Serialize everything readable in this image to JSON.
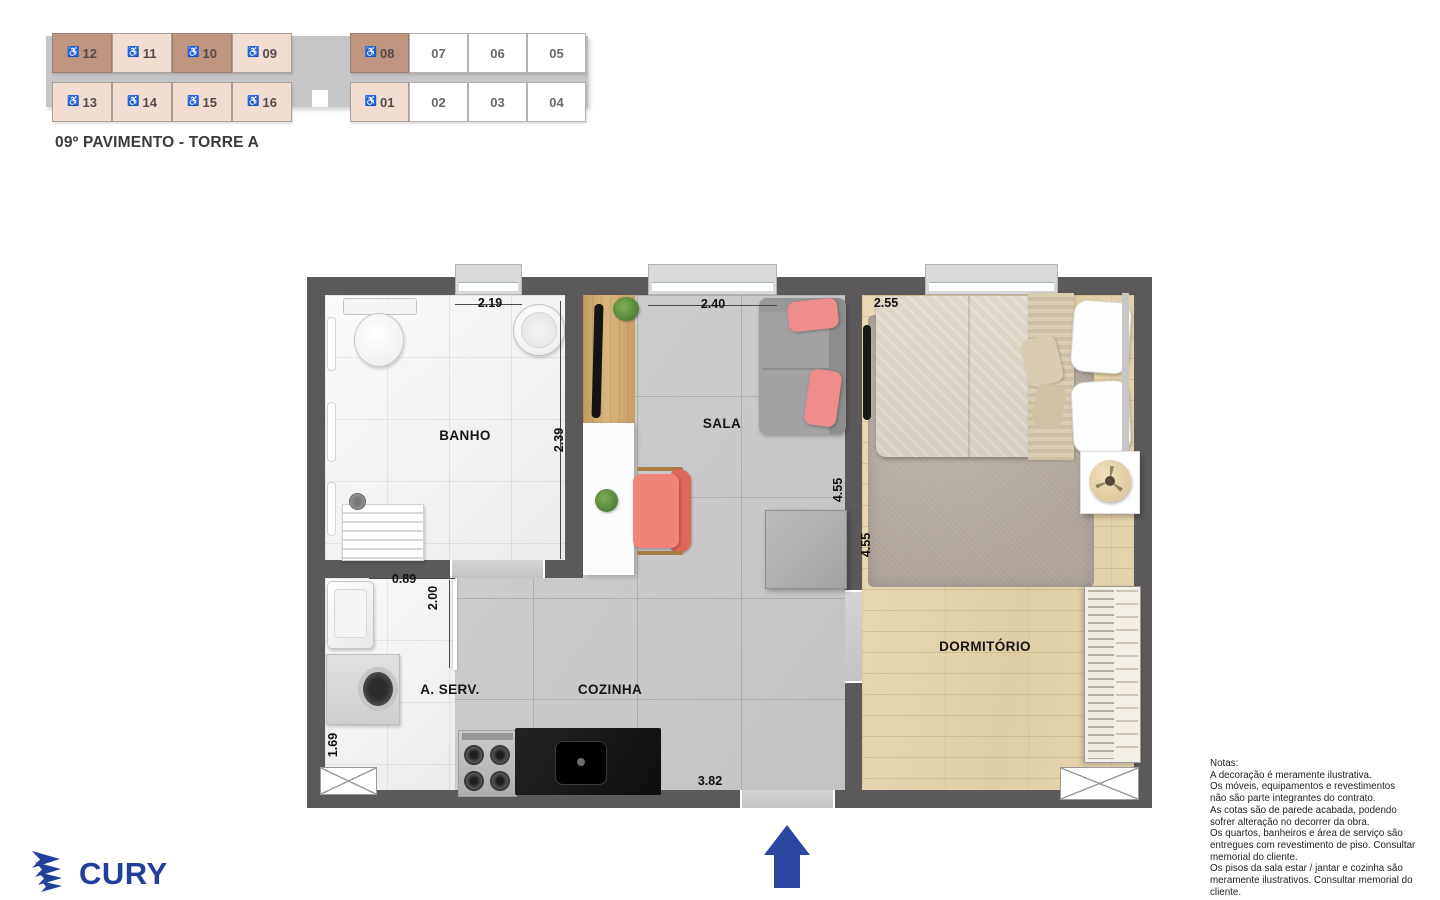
{
  "key_plan": {
    "floor_title": "09º PAVIMENTO - TORRE A",
    "wheelchair_char": "♿",
    "cells": [
      {
        "label": "12",
        "accessible": true,
        "tone": "dark"
      },
      {
        "label": "11",
        "accessible": true,
        "tone": "light"
      },
      {
        "label": "10",
        "accessible": true,
        "tone": "dark"
      },
      {
        "label": "09",
        "accessible": true,
        "tone": "light"
      },
      {
        "label": "08",
        "accessible": true,
        "tone": "dark"
      },
      {
        "label": "07",
        "accessible": false,
        "tone": "white"
      },
      {
        "label": "06",
        "accessible": false,
        "tone": "white"
      },
      {
        "label": "05",
        "accessible": false,
        "tone": "white"
      },
      {
        "label": "13",
        "accessible": true,
        "tone": "light"
      },
      {
        "label": "14",
        "accessible": true,
        "tone": "light"
      },
      {
        "label": "15",
        "accessible": true,
        "tone": "light"
      },
      {
        "label": "16",
        "accessible": true,
        "tone": "light"
      },
      {
        "label": "01",
        "accessible": true,
        "tone": "light"
      },
      {
        "label": "02",
        "accessible": false,
        "tone": "white"
      },
      {
        "label": "03",
        "accessible": false,
        "tone": "white"
      },
      {
        "label": "04",
        "accessible": false,
        "tone": "white"
      }
    ]
  },
  "floor_plan": {
    "rooms": {
      "banho": "BANHO",
      "sala": "SALA",
      "dormitorio": "DORMITÓRIO",
      "aserv": "A. SERV.",
      "cozinha": "COZINHA"
    },
    "dimensions": {
      "banho_w": "2.19",
      "sala_w": "2.40",
      "dorm_w": "2.55",
      "banho_h": "2.39",
      "sala_h": "4.55",
      "dorm_h": "4.55",
      "aserv_w": "0.89",
      "aserv_h": "2.00",
      "aserv_h2": "1.69",
      "cozinha_w": "3.82"
    }
  },
  "notes": {
    "title": "Notas:",
    "body": "A decoração é meramente ilustrativa.\nOs móveis, equipamentos e revestimentos\nnão são parte integrantes do contrato.\nAs cotas são de parede acabada, podendo\nsofrer alteração no decorrer da obra.\nOs quartos, banheiros e área de serviço são\nentregues com revestimento de piso. Consultar\nmemorial do cliente.\nOs pisos da sala estar / jantar e cozinha são\nmeramente ilustrativos. Consultar memorial do\ncliente."
  },
  "logo": {
    "text": "CURY"
  },
  "colors": {
    "unit_dark": "#c0957f",
    "unit_light": "#f2ddd2",
    "wall": "#5c595a",
    "accent_blue": "#2c47a0",
    "logo_blue": "#20409a"
  }
}
